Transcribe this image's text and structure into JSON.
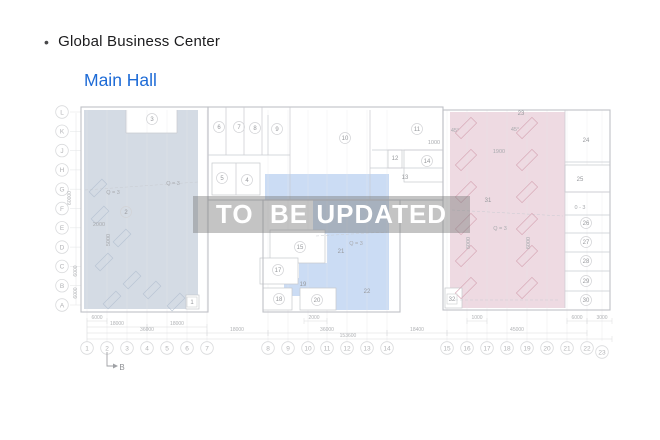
{
  "header": {
    "bullet": "•",
    "title": "Global Business Center",
    "subtitle": "Main Hall"
  },
  "watermark": {
    "text": "TO  BE UPDATED"
  },
  "colors": {
    "subtitle_blue": "#1e6bd6",
    "zone_slate": "#d4dbe4",
    "zone_blue": "#cbdcf4",
    "zone_pink": "#eedae2",
    "watermark_band": "rgba(125,125,125,0.45)",
    "wall": "#bfc1c6",
    "inner_wall": "#c9cbd0",
    "faint": "#e7e8ea",
    "bubble_stroke": "#d9dadc",
    "bubble_text": "#b2b3b6",
    "room_text": "#97999d",
    "dim_text": "#b0b2b5",
    "hatch_pink": "#d8aab8",
    "hatch_slate": "#b2bfd0"
  },
  "plan": {
    "row_labels": [
      "L",
      "K",
      "J",
      "H",
      "G",
      "F",
      "E",
      "D",
      "C",
      "B",
      "A"
    ],
    "col_labels": [
      "1",
      "2",
      "3",
      "4",
      "5",
      "6",
      "7",
      "8",
      "9",
      "10",
      "11",
      "12",
      "13",
      "14",
      "15",
      "16",
      "17",
      "18",
      "19",
      "20",
      "21",
      "22",
      "23"
    ],
    "rooms": [
      {
        "n": "1",
        "x": 192,
        "y": 302,
        "s": "box"
      },
      {
        "n": "2",
        "x": 126,
        "y": 212,
        "s": "circle"
      },
      {
        "n": "3",
        "x": 152,
        "y": 119,
        "s": "circle"
      },
      {
        "n": "4",
        "x": 247,
        "y": 180,
        "s": "circle"
      },
      {
        "n": "5",
        "x": 222,
        "y": 178,
        "s": "circle"
      },
      {
        "n": "6",
        "x": 219,
        "y": 127,
        "s": "circle"
      },
      {
        "n": "7",
        "x": 239,
        "y": 127,
        "s": "circle"
      },
      {
        "n": "8",
        "x": 255,
        "y": 128,
        "s": "circle"
      },
      {
        "n": "9",
        "x": 277,
        "y": 129,
        "s": "circle"
      },
      {
        "n": "10",
        "x": 345,
        "y": 138,
        "s": "circle"
      },
      {
        "n": "11",
        "x": 417,
        "y": 129,
        "s": "circle"
      },
      {
        "n": "12",
        "x": 395,
        "y": 158,
        "s": "plain"
      },
      {
        "n": "13",
        "x": 405,
        "y": 177,
        "s": "plain"
      },
      {
        "n": "14",
        "x": 427,
        "y": 161,
        "s": "circle"
      },
      {
        "n": "15",
        "x": 300,
        "y": 247,
        "s": "circle"
      },
      {
        "n": "17",
        "x": 278,
        "y": 270,
        "s": "circle"
      },
      {
        "n": "18",
        "x": 279,
        "y": 299,
        "s": "circle"
      },
      {
        "n": "19",
        "x": 303,
        "y": 284,
        "s": "plain"
      },
      {
        "n": "20",
        "x": 317,
        "y": 300,
        "s": "circle"
      },
      {
        "n": "21",
        "x": 341,
        "y": 251,
        "s": "plain"
      },
      {
        "n": "22",
        "x": 367,
        "y": 291,
        "s": "plain"
      },
      {
        "n": "23",
        "x": 521,
        "y": 113,
        "s": "plain"
      },
      {
        "n": "24",
        "x": 586,
        "y": 140,
        "s": "plain"
      },
      {
        "n": "25",
        "x": 580,
        "y": 179,
        "s": "plain"
      },
      {
        "n": "26",
        "x": 586,
        "y": 223,
        "s": "circle"
      },
      {
        "n": "27",
        "x": 586,
        "y": 242,
        "s": "circle"
      },
      {
        "n": "28",
        "x": 586,
        "y": 261,
        "s": "circle"
      },
      {
        "n": "29",
        "x": 586,
        "y": 281,
        "s": "circle"
      },
      {
        "n": "30",
        "x": 586,
        "y": 300,
        "s": "circle"
      },
      {
        "n": "31",
        "x": 488,
        "y": 200,
        "s": "plain"
      },
      {
        "n": "32",
        "x": 452,
        "y": 299,
        "s": "box"
      }
    ],
    "notes": [
      {
        "t": "Q = 3",
        "x": 173,
        "y": 185
      },
      {
        "t": "Q = 3",
        "x": 113,
        "y": 194
      },
      {
        "t": "2000",
        "x": 99,
        "y": 226
      },
      {
        "t": "5000",
        "x": 110,
        "y": 240,
        "rot": -90
      },
      {
        "t": "Q = 3",
        "x": 356,
        "y": 245
      },
      {
        "t": "Q = 3",
        "x": 500,
        "y": 230
      },
      {
        "t": "0 - 3",
        "x": 580,
        "y": 209
      },
      {
        "t": "1900",
        "x": 499,
        "y": 153
      },
      {
        "t": "1000",
        "x": 434,
        "y": 144
      },
      {
        "t": "45°",
        "x": 455,
        "y": 132
      },
      {
        "t": "45°",
        "x": 515,
        "y": 131
      },
      {
        "t": "6000",
        "x": 470,
        "y": 243,
        "rot": -90
      },
      {
        "t": "6000",
        "x": 530,
        "y": 243,
        "rot": -90
      }
    ],
    "dims_left": [
      {
        "t": "60000",
        "x": 71,
        "y": 198
      },
      {
        "t": "6000",
        "x": 77,
        "y": 271
      },
      {
        "t": "6000",
        "x": 77,
        "y": 293
      }
    ],
    "dims_bottom": [
      {
        "t": "6000",
        "x": 97,
        "y": 319,
        "x1": 87,
        "x2": 107
      },
      {
        "t": "2000",
        "x": 314,
        "y": 319,
        "x1": 304,
        "x2": 327
      },
      {
        "t": "1000",
        "x": 477,
        "y": 319,
        "x1": 467,
        "x2": 487
      },
      {
        "t": "6000",
        "x": 577,
        "y": 319,
        "x1": 567,
        "x2": 587
      },
      {
        "t": "3000",
        "x": 602,
        "y": 319,
        "x1": 587,
        "x2": 612
      },
      {
        "t": "18000",
        "x": 117,
        "y": 325,
        "x1": 87,
        "x2": 147
      },
      {
        "t": "18000",
        "x": 177,
        "y": 325,
        "x1": 147,
        "x2": 207
      },
      {
        "t": "36000",
        "x": 147,
        "y": 331,
        "x1": 87,
        "x2": 207
      },
      {
        "t": "18000",
        "x": 237,
        "y": 331,
        "x1": 207,
        "x2": 268
      },
      {
        "t": "36000",
        "x": 327,
        "y": 331,
        "x1": 268,
        "x2": 387
      },
      {
        "t": "18400",
        "x": 417,
        "y": 331,
        "x1": 387,
        "x2": 447
      },
      {
        "t": "45000",
        "x": 517,
        "y": 331,
        "x1": 447,
        "x2": 587
      },
      {
        "t": "153600",
        "x": 348,
        "y": 337,
        "x1": 87,
        "x2": 612
      }
    ],
    "section_marker": {
      "label": "B"
    }
  }
}
